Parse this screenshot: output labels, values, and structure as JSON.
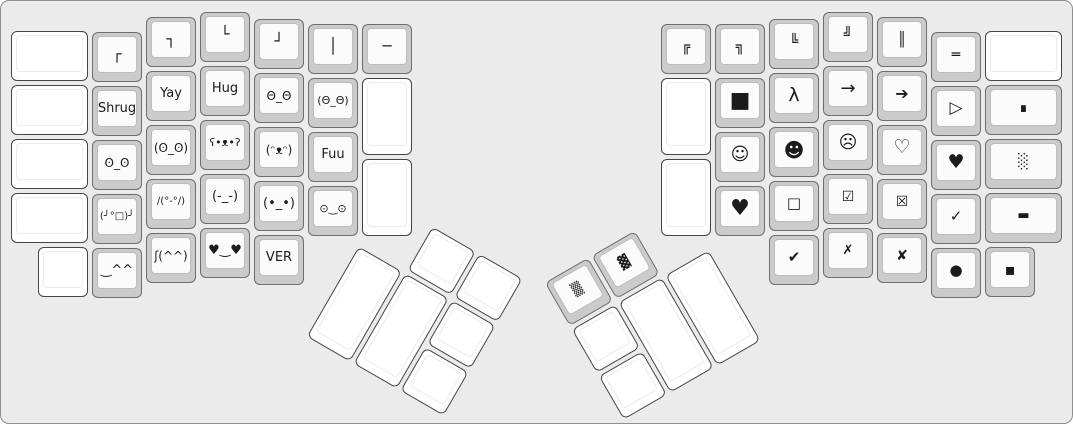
{
  "canvas": {
    "width": 1073,
    "height": 424,
    "background_color": "#ebebeb",
    "border_color": "#8f8f8f",
    "cap_gray": "#cbcbcb",
    "cap_white": "#ffffff",
    "face_color": "#fbfbfb",
    "legend_color": "#1b1b1b"
  },
  "left_main": {
    "origin_x": 0,
    "origin_y": 0,
    "rotation_deg": 0,
    "keys": [
      {
        "name": "key-blank",
        "legend": "",
        "x": 10,
        "y": 30,
        "w": 77,
        "cap": "white"
      },
      {
        "name": "key-blank",
        "legend": "",
        "x": 10,
        "y": 84,
        "w": 77,
        "cap": "white"
      },
      {
        "name": "key-blank",
        "legend": "",
        "x": 10,
        "y": 138,
        "w": 77,
        "cap": "white"
      },
      {
        "name": "key-blank",
        "legend": "",
        "x": 10,
        "y": 192,
        "w": 77,
        "cap": "white"
      },
      {
        "name": "key-blank",
        "legend": "",
        "x": 37,
        "y": 246,
        "cap": "white"
      },
      {
        "name": "key-box-corner-top-left",
        "legend": "┌",
        "x": 91,
        "y": 31,
        "cap": "gray",
        "size": 15
      },
      {
        "name": "key-shrug",
        "legend": "Shrug",
        "x": 91,
        "y": 85,
        "cap": "gray",
        "size": 13
      },
      {
        "name": "key-look-of-disapproval",
        "legend": "ʘ_ʘ",
        "x": 91,
        "y": 139,
        "cap": "gray",
        "size": 12
      },
      {
        "name": "key-table-flip",
        "legend": "(╯°□)╯",
        "x": 91,
        "y": 193,
        "cap": "gray",
        "size": 10
      },
      {
        "name": "key-happy-carets",
        "legend": "‿^^",
        "x": 91,
        "y": 247,
        "cap": "gray",
        "size": 13
      },
      {
        "name": "key-box-corner-top-right",
        "legend": "┐",
        "x": 145,
        "y": 16,
        "cap": "gray",
        "size": 15
      },
      {
        "name": "key-yay",
        "legend": "Yay",
        "x": 145,
        "y": 70,
        "cap": "gray",
        "size": 13
      },
      {
        "name": "key-disapproval-paren",
        "legend": "(ʘ_ʘ)",
        "x": 145,
        "y": 124,
        "cap": "gray",
        "size": 12
      },
      {
        "name": "key-table-unflip",
        "legend": "∕(°-°∕)",
        "x": 145,
        "y": 178,
        "cap": "gray",
        "size": 10
      },
      {
        "name": "key-esh-smile",
        "legend": "ʃ(^^)",
        "x": 145,
        "y": 232,
        "cap": "gray",
        "size": 12
      },
      {
        "name": "key-box-corner-bottom-left",
        "legend": "└",
        "x": 199,
        "y": 11,
        "cap": "gray",
        "size": 15
      },
      {
        "name": "key-hug",
        "legend": "Hug",
        "x": 199,
        "y": 65,
        "cap": "gray",
        "size": 13
      },
      {
        "name": "key-bear-face",
        "legend": "ʕ•ᴥ•ʔ",
        "x": 199,
        "y": 119,
        "cap": "gray",
        "size": 11
      },
      {
        "name": "key-annoyed-face",
        "legend": "(-_-)",
        "x": 199,
        "y": 173,
        "cap": "gray",
        "size": 13
      },
      {
        "name": "key-heart-eyes",
        "legend": "♥‿♥",
        "x": 199,
        "y": 227,
        "cap": "gray",
        "size": 13
      },
      {
        "name": "key-box-corner-bottom-right",
        "legend": "┘",
        "x": 253,
        "y": 18,
        "cap": "gray",
        "size": 15
      },
      {
        "name": "key-wide-eyes",
        "legend": "Θ_Θ",
        "x": 253,
        "y": 72,
        "cap": "gray",
        "size": 12
      },
      {
        "name": "key-dog-face",
        "legend": "(ᵔᴥᵔ)",
        "x": 253,
        "y": 126,
        "cap": "gray",
        "size": 12
      },
      {
        "name": "key-staring-face",
        "legend": "(•_•)",
        "x": 253,
        "y": 180,
        "cap": "gray",
        "size": 13
      },
      {
        "name": "key-ver",
        "legend": "VER",
        "x": 253,
        "y": 234,
        "cap": "gray",
        "size": 13
      },
      {
        "name": "key-box-vertical",
        "legend": "│",
        "x": 307,
        "y": 23,
        "cap": "gray",
        "size": 15
      },
      {
        "name": "key-wide-eyes-paren",
        "legend": "(Θ_Θ)",
        "x": 307,
        "y": 77,
        "cap": "gray",
        "size": 11
      },
      {
        "name": "key-fuu",
        "legend": "Fuu",
        "x": 307,
        "y": 131,
        "cap": "gray",
        "size": 13
      },
      {
        "name": "key-worried-face",
        "legend": "⊙‿⊙",
        "x": 307,
        "y": 185,
        "cap": "gray",
        "size": 11
      },
      {
        "name": "key-box-horizontal",
        "legend": "─",
        "x": 361,
        "y": 23,
        "cap": "gray",
        "size": 15
      },
      {
        "name": "key-blank-tall",
        "legend": "",
        "x": 361,
        "y": 77,
        "h": 77,
        "cap": "white"
      },
      {
        "name": "key-blank-tall",
        "legend": "",
        "x": 361,
        "y": 158,
        "h": 77,
        "cap": "white"
      }
    ]
  },
  "right_main": {
    "origin_x": 0,
    "origin_y": 0,
    "rotation_deg": 0,
    "keys": [
      {
        "name": "key-double-corner-top-left",
        "legend": "╔",
        "x": 660,
        "y": 23,
        "cap": "gray",
        "size": 14
      },
      {
        "name": "key-blank-tall",
        "legend": "",
        "x": 660,
        "y": 77,
        "h": 77,
        "cap": "white"
      },
      {
        "name": "key-blank-tall",
        "legend": "",
        "x": 660,
        "y": 158,
        "h": 77,
        "cap": "white"
      },
      {
        "name": "key-double-corner-top-right",
        "legend": "╗",
        "x": 714,
        "y": 23,
        "cap": "gray",
        "size": 14
      },
      {
        "name": "key-black-square-large",
        "legend": "■",
        "x": 714,
        "y": 77,
        "cap": "gray",
        "size": 22
      },
      {
        "name": "key-smiley-white",
        "legend": "☺",
        "x": 714,
        "y": 131,
        "cap": "gray",
        "size": 18
      },
      {
        "name": "key-heart-large",
        "legend": "♥",
        "x": 714,
        "y": 185,
        "cap": "gray",
        "size": 22
      },
      {
        "name": "key-double-corner-bottom-left",
        "legend": "╚",
        "x": 768,
        "y": 18,
        "cap": "gray",
        "size": 14
      },
      {
        "name": "key-lambda",
        "legend": "λ",
        "x": 768,
        "y": 72,
        "cap": "gray",
        "size": 19
      },
      {
        "name": "key-smiley-black",
        "legend": "☻",
        "x": 768,
        "y": 126,
        "cap": "gray",
        "size": 20
      },
      {
        "name": "key-square-white",
        "legend": "□",
        "x": 768,
        "y": 180,
        "cap": "gray",
        "size": 15
      },
      {
        "name": "key-check-heavy",
        "legend": "✔",
        "x": 768,
        "y": 234,
        "cap": "gray",
        "size": 15
      },
      {
        "name": "key-double-corner-bottom-right",
        "legend": "╝",
        "x": 822,
        "y": 11,
        "cap": "gray",
        "size": 14
      },
      {
        "name": "key-arrow-right",
        "legend": "→",
        "x": 822,
        "y": 65,
        "cap": "gray",
        "size": 18
      },
      {
        "name": "key-frown-face",
        "legend": "☹",
        "x": 822,
        "y": 119,
        "cap": "gray",
        "size": 18
      },
      {
        "name": "key-checked-box",
        "legend": "☑",
        "x": 822,
        "y": 173,
        "cap": "gray",
        "size": 14
      },
      {
        "name": "key-x-mark",
        "legend": "✗",
        "x": 822,
        "y": 227,
        "cap": "gray",
        "size": 13
      },
      {
        "name": "key-double-vertical",
        "legend": "║",
        "x": 876,
        "y": 16,
        "cap": "gray",
        "size": 14
      },
      {
        "name": "key-arrow-right-heavy",
        "legend": "➔",
        "x": 876,
        "y": 70,
        "cap": "gray",
        "size": 16
      },
      {
        "name": "key-heart-white",
        "legend": "♡",
        "x": 876,
        "y": 124,
        "cap": "gray",
        "size": 19
      },
      {
        "name": "key-crossed-box",
        "legend": "☒",
        "x": 876,
        "y": 178,
        "cap": "gray",
        "size": 14
      },
      {
        "name": "key-x-heavy",
        "legend": "✘",
        "x": 876,
        "y": 232,
        "cap": "gray",
        "size": 14
      },
      {
        "name": "key-double-horizontal",
        "legend": "═",
        "x": 930,
        "y": 31,
        "cap": "gray",
        "size": 14
      },
      {
        "name": "key-triangle-right",
        "legend": "▷",
        "x": 930,
        "y": 85,
        "cap": "gray",
        "size": 17
      },
      {
        "name": "key-heart-black",
        "legend": "♥",
        "x": 930,
        "y": 139,
        "cap": "gray",
        "size": 19
      },
      {
        "name": "key-check-mark",
        "legend": "✓",
        "x": 930,
        "y": 193,
        "cap": "gray",
        "size": 15
      },
      {
        "name": "key-black-circle",
        "legend": "●",
        "x": 930,
        "y": 247,
        "cap": "gray",
        "size": 15
      },
      {
        "name": "key-blank",
        "legend": "",
        "x": 984,
        "y": 30,
        "w": 77,
        "cap": "white"
      },
      {
        "name": "key-qed-square",
        "legend": "∎",
        "x": 984,
        "y": 84,
        "w": 77,
        "cap": "gray",
        "size": 14
      },
      {
        "name": "key-shade-light",
        "legend": "░",
        "x": 984,
        "y": 138,
        "w": 77,
        "cap": "gray",
        "size": 14
      },
      {
        "name": "key-black-bar",
        "legend": "▬",
        "x": 984,
        "y": 192,
        "w": 77,
        "cap": "gray",
        "size": 13
      },
      {
        "name": "key-black-small-square",
        "legend": "▪",
        "x": 984,
        "y": 246,
        "cap": "gray",
        "size": 16
      }
    ]
  },
  "left_thumb": {
    "origin_x": 384,
    "origin_y": 196,
    "rotation_deg": 30,
    "keys": [
      {
        "name": "key-blank",
        "legend": "",
        "x": 56,
        "y": 2,
        "cap": "white"
      },
      {
        "name": "key-blank",
        "legend": "",
        "x": 110,
        "y": 2,
        "cap": "white"
      },
      {
        "name": "key-blank-2u",
        "legend": "",
        "x": 2,
        "y": 56,
        "h": 104,
        "cap": "white"
      },
      {
        "name": "key-blank-2u",
        "legend": "",
        "x": 56,
        "y": 56,
        "h": 104,
        "cap": "white"
      },
      {
        "name": "key-blank",
        "legend": "",
        "x": 110,
        "y": 56,
        "cap": "white"
      },
      {
        "name": "key-blank",
        "legend": "",
        "x": 110,
        "y": 110,
        "cap": "white"
      }
    ]
  },
  "right_thumb": {
    "origin_x": 541,
    "origin_y": 281,
    "rotation_deg": -30,
    "keys": [
      {
        "name": "key-shade-medium",
        "legend": "▒",
        "x": 2,
        "y": 2,
        "cap": "gray",
        "size": 13
      },
      {
        "name": "key-shade-dark",
        "legend": "▓",
        "x": 56,
        "y": 2,
        "cap": "gray",
        "size": 13
      },
      {
        "name": "key-blank",
        "legend": "",
        "x": 2,
        "y": 56,
        "cap": "white"
      },
      {
        "name": "key-blank-2u",
        "legend": "",
        "x": 56,
        "y": 56,
        "h": 104,
        "cap": "white"
      },
      {
        "name": "key-blank-2u",
        "legend": "",
        "x": 110,
        "y": 56,
        "h": 104,
        "cap": "white"
      },
      {
        "name": "key-blank",
        "legend": "",
        "x": 2,
        "y": 110,
        "cap": "white"
      }
    ]
  }
}
